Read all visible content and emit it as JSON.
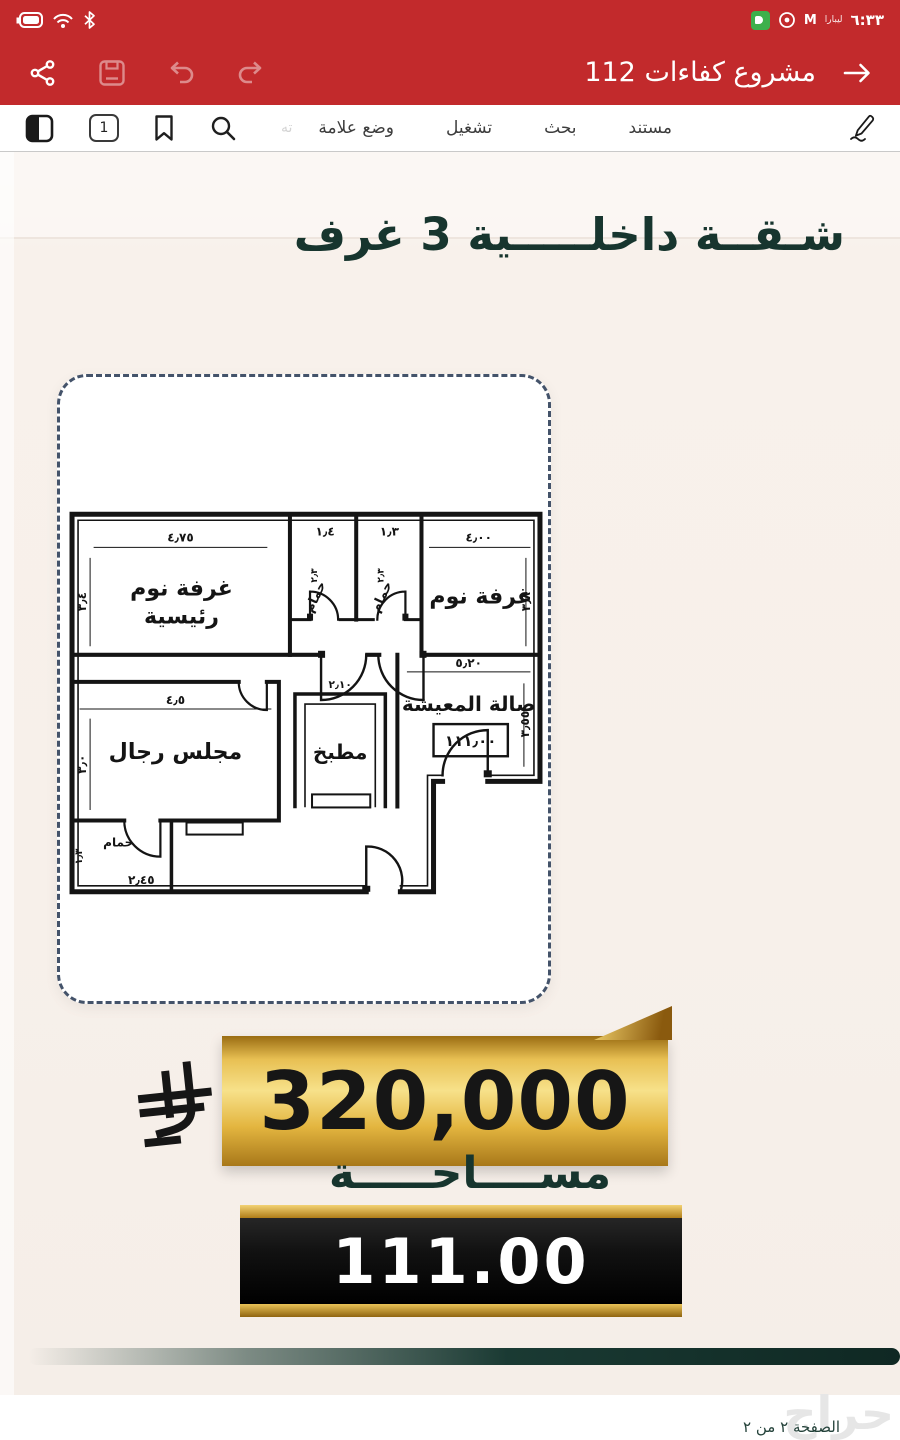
{
  "status_bar": {
    "time": "٦:٣٣",
    "carrier_text": "ليبارا",
    "gmail_letter": "M"
  },
  "app_bar": {
    "title": "مشروع كفاءات 112"
  },
  "tab_bar": {
    "page_number": "1",
    "clipped_tab_label": "ته",
    "tabs": [
      {
        "label": "وضع علامة"
      },
      {
        "label": "تشغيل"
      },
      {
        "label": "بحث"
      },
      {
        "label": "مستند"
      }
    ]
  },
  "flyer": {
    "title": "شـقــة داخلـــــية 3 غرف",
    "price": "320,000",
    "area_label": "مســــاحـــــة",
    "area_value": "111.00"
  },
  "floor_plan": {
    "labels": {
      "master_line1": "غرفة نوم",
      "master_line2": "رئيسية",
      "bath1": "حمام",
      "bath2": "حمام",
      "bedroom": "غرفة نوم",
      "majlis": "مجلس رجال",
      "kitchen": "مطبخ",
      "living": "صالة المعيشة",
      "small_bath": "حمام",
      "area_box": "١١١٫٠٠"
    },
    "dims": {
      "master_w": "٤٫٧٥",
      "master_h": "٣٫٤",
      "bath1_w": "١٫٤",
      "bath1_h": "٢٫٣",
      "bath2_w": "١٫٣",
      "bath2_h": "٢٫٣",
      "bedroom_w": "٤٫٠٠",
      "bedroom_h": "٣٫٨",
      "majlis_w": "٤٫٥",
      "majlis_h": "٣٫٠",
      "kitchen_w": "٢٫١٠",
      "living_w": "٥٫٢٠",
      "living_h": "٣٫٥٥",
      "small_bath_w": "٢٫٤٥",
      "small_bath_h": "١٫٣"
    }
  },
  "footer": {
    "page_indicator": "الصفحة ٢ من ٢",
    "watermark": "حراج"
  }
}
